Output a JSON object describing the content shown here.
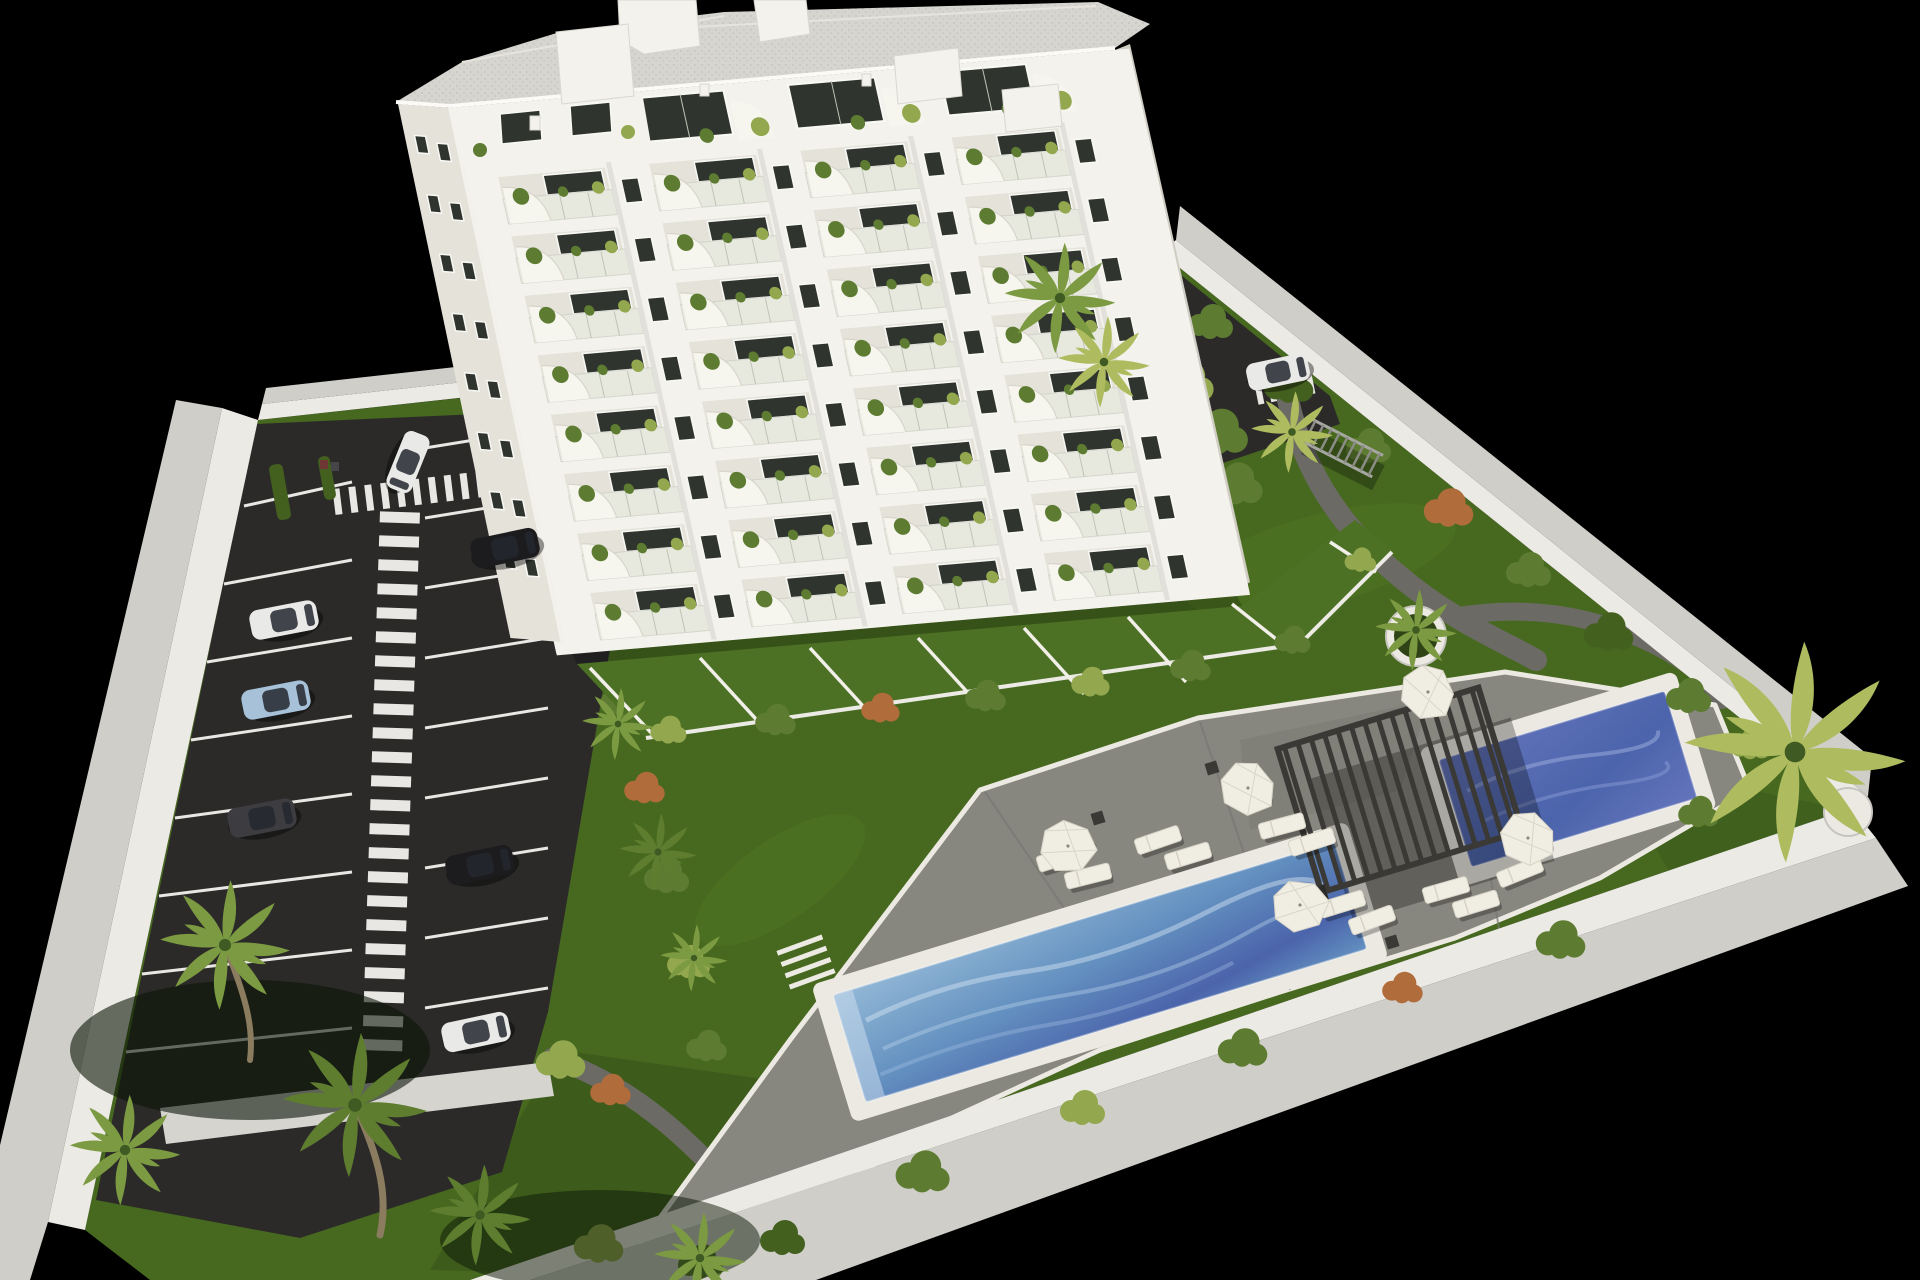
{
  "scene": {
    "type": "architectural-3d-render",
    "view": "aerial three-quarter perspective on black backdrop",
    "description": "Aerial 3D architectural rendering of a residential development: a white multi-storey apartment building with plant-filled balconies and curved white awnings, a gated plot enclosed by a white perimeter wall, a private parking lot with marked stalls, striped pedestrian walkways and parked cars, landscaped gardens with palm trees and shrubs, a large sun deck with two blue swimming pools, a slatted pergola, parasols and sun loungers."
  },
  "building": {
    "floors_visible": 9,
    "balcony_bays_per_floor": 4,
    "features": [
      "glass balcony railings",
      "potted balcony plants",
      "curved white balcony awnings",
      "penthouse terraces",
      "gravel flat roof with stair bulkheads",
      "ground-floor private garden patios"
    ]
  },
  "amenities": {
    "pools": [
      {
        "name": "main-pool",
        "water": "light-blue"
      },
      {
        "name": "spa-pool",
        "water": "deep-blue"
      }
    ],
    "pergolas": 1,
    "parasols": 5,
    "sun_loungers": 11,
    "palm_trees": 13,
    "garden_paths": 3
  },
  "parking": {
    "marked_stalls": 16,
    "zebra_walkways": 3,
    "cars": [
      {
        "color": "white",
        "location": "entrance lane"
      },
      {
        "color": "black",
        "location": "upper right stall"
      },
      {
        "color": "white",
        "location": "left stall"
      },
      {
        "color": "light-blue",
        "location": "left stall"
      },
      {
        "color": "dark-gray",
        "location": "left stall"
      },
      {
        "color": "black",
        "location": "lower right stall"
      },
      {
        "color": "white",
        "location": "bottom right stall"
      },
      {
        "color": "white",
        "location": "rear driveway"
      }
    ]
  },
  "colors": {
    "background": "#000000",
    "building_white": "#f3f2ec",
    "building_shade": "#e4e2d9",
    "side_shade": "#d0cdc4",
    "glass_dark": "#30342e",
    "glass_frame": "#f8f8f4",
    "railing_glass": "#dfe2d6",
    "railing_frame": "#bfc3b6",
    "awning": "#f6f5ee",
    "roof": "#d6d5d0",
    "roof_dot": "#c2c1bb",
    "wall_top": "#eceae4",
    "wall_face": "#cfcec8",
    "lawn": "#47691f",
    "lawn_light": "#578229",
    "lawn_dark": "#35521a",
    "asphalt": "#2b2a29",
    "marking": "#e8e7e3",
    "sidewalk": "#d5d4cf",
    "path": "#6b6a64",
    "deck": "#87867f",
    "deck_dark": "#787771",
    "coping": "#ebe9e1",
    "pool_light": "#93b8d6",
    "pool_mid": "#6390c0",
    "pool_deep": "#4b64ab",
    "pool_deep2": "#6474bc",
    "pergola": "#3a3936",
    "furniture": "#f0ede2",
    "furniture_edge": "#d6d3c6",
    "bush_green": "#5d7c31",
    "bush_dark": "#43601f",
    "bush_light": "#93a84e",
    "bush_autumn": "#b06c3a",
    "palm_green": "#7b9a41",
    "palm_dark": "#5e7d2f",
    "palm_yellow": "#aebc5f",
    "palm_core": "#3f5a22",
    "trunk": "#8b7c5f",
    "car_white": "#e9e9e7",
    "car_black": "#1c1c1f",
    "car_gray": "#3c3c41",
    "car_blue": "#a6c1d8",
    "car_glass": "#23272e"
  }
}
